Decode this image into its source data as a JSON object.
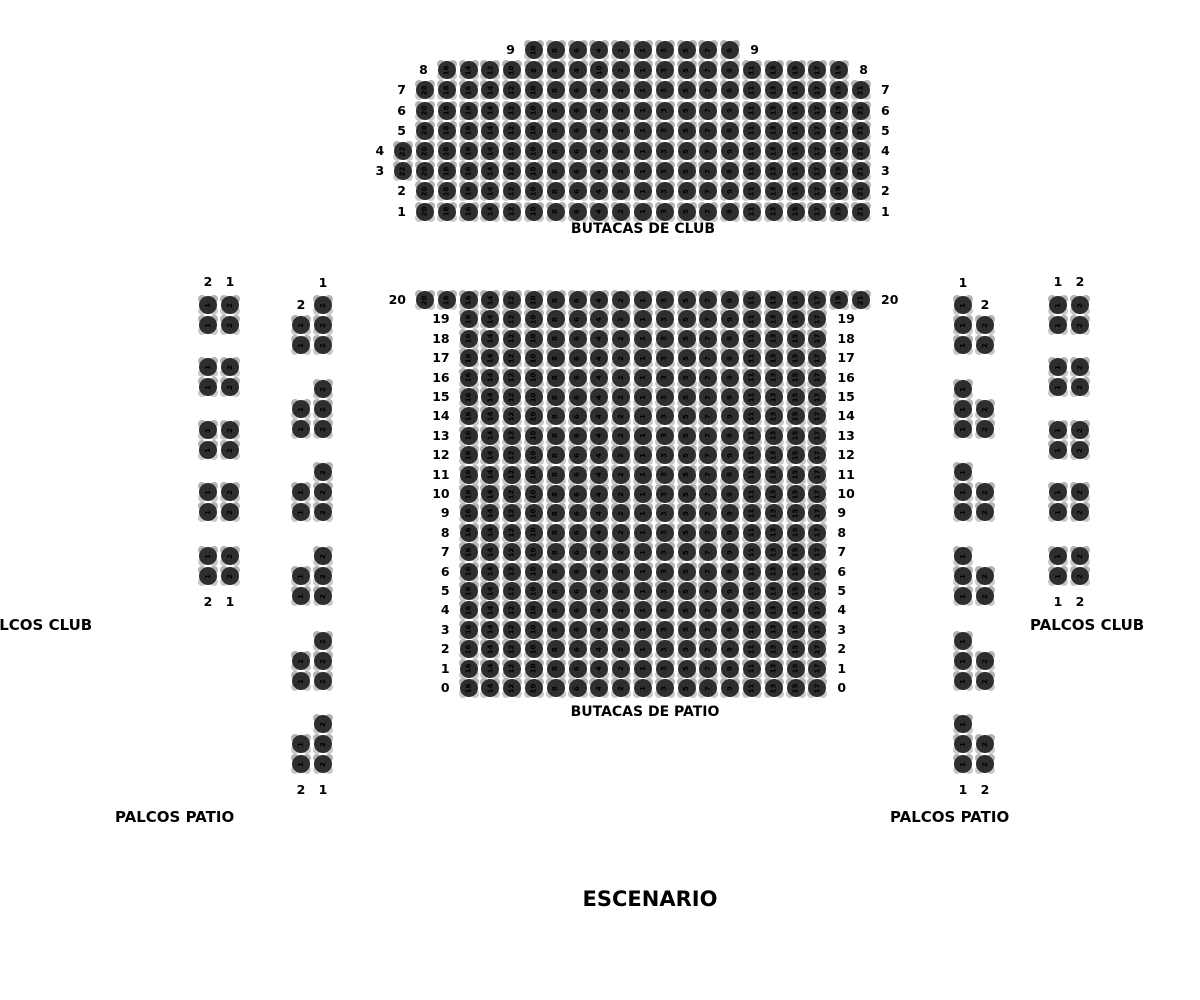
{
  "section_labels": {
    "club": "BUTACAS DE CLUB",
    "patio": "BUTACAS DE PATIO",
    "palcos_club_left": "PALCOS CLUB",
    "palcos_club_right": "PALCOS CLUB",
    "palcos_patio_left": "PALCOS PATIO",
    "palcos_patio_right": "PALCOS PATIO",
    "stage": "ESCENARIO"
  },
  "colors": {
    "seat_fill": "#2e2e2e",
    "seat_number": "#000000",
    "label_text": "#000000",
    "background": "#ffffff"
  },
  "club": {
    "rows": [
      {
        "label": "9",
        "start_col": -5,
        "seats": [
          10,
          8,
          6,
          4,
          2,
          1,
          3,
          5,
          7,
          9
        ]
      },
      {
        "label": "8",
        "start_col": -9,
        "seats": [
          16,
          14,
          12,
          10,
          8,
          6,
          4,
          10,
          2,
          1,
          3,
          5,
          7,
          9,
          11,
          13,
          15,
          17,
          19
        ]
      },
      {
        "label": "7",
        "start_col": -10,
        "seats": [
          20,
          18,
          16,
          14,
          12,
          10,
          8,
          6,
          4,
          2,
          1,
          3,
          5,
          7,
          9,
          11,
          13,
          15,
          17,
          19,
          21
        ]
      },
      {
        "label": "6",
        "start_col": -10,
        "seats": [
          20,
          18,
          16,
          14,
          12,
          10,
          8,
          6,
          4,
          2,
          1,
          3,
          5,
          7,
          9,
          11,
          13,
          15,
          17,
          19,
          21
        ]
      },
      {
        "label": "5",
        "start_col": -10,
        "seats": [
          20,
          18,
          16,
          14,
          12,
          10,
          8,
          6,
          4,
          2,
          1,
          3,
          5,
          7,
          9,
          11,
          13,
          15,
          17,
          19,
          21
        ]
      },
      {
        "label": "4",
        "start_col": -11,
        "seats": [
          22,
          20,
          18,
          16,
          14,
          12,
          10,
          8,
          6,
          4,
          2,
          1,
          3,
          5,
          7,
          9,
          11,
          13,
          15,
          17,
          19,
          21
        ]
      },
      {
        "label": "3",
        "start_col": -11,
        "seats": [
          22,
          20,
          18,
          16,
          14,
          12,
          10,
          8,
          6,
          4,
          2,
          1,
          3,
          5,
          7,
          9,
          11,
          13,
          15,
          17,
          19,
          21
        ]
      },
      {
        "label": "2",
        "start_col": -10,
        "seats": [
          20,
          18,
          16,
          14,
          12,
          10,
          8,
          6,
          4,
          2,
          1,
          3,
          5,
          7,
          9,
          11,
          13,
          15,
          17,
          19,
          21
        ]
      },
      {
        "label": "1",
        "start_col": -10,
        "seats": [
          20,
          18,
          16,
          14,
          12,
          10,
          8,
          6,
          4,
          2,
          1,
          3,
          5,
          7,
          9,
          11,
          13,
          15,
          17,
          19,
          21
        ]
      }
    ]
  },
  "patio": {
    "rows": [
      {
        "label": "20",
        "start_col": -10,
        "seats": [
          20,
          18,
          16,
          14,
          12,
          10,
          8,
          6,
          4,
          2,
          1,
          3,
          5,
          7,
          9,
          11,
          13,
          15,
          17,
          19,
          21
        ]
      },
      {
        "label": "19",
        "start_col": -8,
        "seats": [
          16,
          14,
          12,
          10,
          8,
          6,
          4,
          2,
          1,
          3,
          5,
          7,
          9,
          11,
          13,
          15,
          17
        ]
      },
      {
        "label": "18",
        "start_col": -8,
        "seats": [
          16,
          14,
          12,
          10,
          8,
          6,
          4,
          2,
          1,
          3,
          5,
          7,
          9,
          11,
          13,
          15,
          17
        ]
      },
      {
        "label": "17",
        "start_col": -8,
        "seats": [
          16,
          14,
          12,
          10,
          8,
          6,
          4,
          2,
          1,
          3,
          5,
          7,
          9,
          11,
          13,
          15,
          17
        ]
      },
      {
        "label": "16",
        "start_col": -8,
        "seats": [
          16,
          14,
          12,
          10,
          8,
          6,
          4,
          2,
          1,
          3,
          5,
          7,
          9,
          11,
          13,
          15,
          17
        ]
      },
      {
        "label": "15",
        "start_col": -8,
        "seats": [
          16,
          14,
          12,
          10,
          8,
          6,
          4,
          2,
          1,
          3,
          5,
          7,
          9,
          11,
          13,
          15,
          17
        ]
      },
      {
        "label": "14",
        "start_col": -8,
        "seats": [
          16,
          14,
          12,
          10,
          8,
          6,
          4,
          2,
          1,
          3,
          5,
          7,
          9,
          11,
          13,
          15,
          17
        ]
      },
      {
        "label": "13",
        "start_col": -8,
        "seats": [
          16,
          14,
          12,
          10,
          8,
          6,
          4,
          2,
          1,
          3,
          5,
          7,
          9,
          11,
          13,
          15,
          17
        ]
      },
      {
        "label": "12",
        "start_col": -8,
        "seats": [
          16,
          14,
          12,
          10,
          8,
          6,
          4,
          2,
          1,
          3,
          5,
          7,
          9,
          11,
          13,
          15,
          17
        ]
      },
      {
        "label": "11",
        "start_col": -8,
        "seats": [
          16,
          14,
          12,
          10,
          8,
          6,
          4,
          2,
          1,
          3,
          5,
          7,
          9,
          11,
          13,
          15,
          17
        ]
      },
      {
        "label": "10",
        "start_col": -8,
        "seats": [
          16,
          14,
          12,
          10,
          8,
          6,
          4,
          2,
          1,
          3,
          5,
          7,
          9,
          11,
          13,
          15,
          17
        ]
      },
      {
        "label": "9",
        "start_col": -8,
        "seats": [
          16,
          14,
          12,
          10,
          8,
          6,
          4,
          2,
          1,
          3,
          5,
          7,
          9,
          11,
          13,
          15,
          17
        ]
      },
      {
        "label": "8",
        "start_col": -8,
        "seats": [
          16,
          14,
          12,
          10,
          8,
          6,
          4,
          2,
          1,
          3,
          5,
          7,
          9,
          11,
          13,
          15,
          17
        ]
      },
      {
        "label": "7",
        "start_col": -8,
        "seats": [
          16,
          14,
          12,
          10,
          8,
          6,
          4,
          2,
          1,
          3,
          5,
          7,
          9,
          11,
          13,
          15,
          17
        ]
      },
      {
        "label": "6",
        "start_col": -8,
        "seats": [
          16,
          14,
          12,
          10,
          8,
          6,
          4,
          2,
          1,
          3,
          5,
          7,
          9,
          11,
          13,
          15,
          17
        ]
      },
      {
        "label": "5",
        "start_col": -8,
        "seats": [
          16,
          14,
          12,
          10,
          8,
          6,
          4,
          2,
          1,
          3,
          5,
          7,
          9,
          11,
          13,
          15,
          17
        ]
      },
      {
        "label": "4",
        "start_col": -8,
        "seats": [
          16,
          14,
          12,
          10,
          8,
          6,
          4,
          2,
          1,
          3,
          5,
          7,
          9,
          11,
          13,
          15,
          17
        ]
      },
      {
        "label": "3",
        "start_col": -8,
        "seats": [
          16,
          14,
          12,
          10,
          8,
          6,
          4,
          2,
          1,
          3,
          5,
          7,
          9,
          11,
          13,
          15,
          17
        ]
      },
      {
        "label": "2",
        "start_col": -8,
        "seats": [
          16,
          14,
          12,
          10,
          8,
          6,
          4,
          2,
          1,
          3,
          5,
          7,
          9,
          11,
          13,
          15,
          17
        ]
      },
      {
        "label": "1",
        "start_col": -8,
        "seats": [
          16,
          14,
          12,
          10,
          8,
          6,
          4,
          2,
          1,
          3,
          5,
          7,
          9,
          11,
          13,
          15,
          17
        ]
      },
      {
        "label": "0",
        "start_col": -8,
        "seats": [
          16,
          14,
          12,
          10,
          8,
          6,
          4,
          2,
          1,
          3,
          5,
          7,
          9,
          11,
          13,
          15,
          17
        ]
      }
    ]
  },
  "palcos": {
    "left_outer": {
      "top_labels": [
        "2",
        "1"
      ],
      "bottom_labels": [
        "2",
        "1"
      ],
      "groups": [
        [
          [
            1,
            2
          ],
          [
            1,
            2
          ]
        ],
        [
          [
            1,
            2
          ],
          [
            1,
            2
          ]
        ],
        [
          [
            1,
            2
          ],
          [
            1,
            2
          ]
        ],
        [
          [
            1,
            2
          ],
          [
            1,
            2
          ]
        ],
        [
          [
            1,
            2
          ],
          [
            1,
            2
          ]
        ]
      ]
    },
    "left_inner": {
      "header_label": "1",
      "first_row_label": "2",
      "bottom_labels": [
        "2",
        "1"
      ],
      "groups": [
        [
          [
            null,
            2
          ],
          [
            1,
            2
          ],
          [
            1,
            2
          ]
        ],
        [
          [
            null,
            2
          ],
          [
            1,
            2
          ],
          [
            1,
            2
          ]
        ],
        [
          [
            null,
            2
          ],
          [
            1,
            2
          ],
          [
            1,
            2
          ]
        ],
        [
          [
            null,
            2
          ],
          [
            1,
            2
          ],
          [
            1,
            2
          ]
        ],
        [
          [
            null,
            2
          ],
          [
            1,
            2
          ],
          [
            1,
            2
          ]
        ],
        [
          [
            null,
            2
          ],
          [
            1,
            2
          ],
          [
            1,
            2
          ]
        ]
      ]
    },
    "right_inner": {
      "header_label": "1",
      "first_row_label": "2",
      "bottom_labels": [
        "1",
        "2"
      ],
      "groups": [
        [
          [
            1,
            null
          ],
          [
            1,
            2
          ],
          [
            1,
            2
          ]
        ],
        [
          [
            1,
            null
          ],
          [
            1,
            2
          ],
          [
            1,
            2
          ]
        ],
        [
          [
            1,
            null
          ],
          [
            1,
            2
          ],
          [
            1,
            2
          ]
        ],
        [
          [
            1,
            null
          ],
          [
            1,
            2
          ],
          [
            1,
            2
          ]
        ],
        [
          [
            1,
            null
          ],
          [
            1,
            2
          ],
          [
            1,
            2
          ]
        ],
        [
          [
            1,
            null
          ],
          [
            1,
            2
          ],
          [
            1,
            2
          ]
        ]
      ]
    },
    "right_outer": {
      "top_labels": [
        "1",
        "2"
      ],
      "bottom_labels": [
        "1",
        "2"
      ],
      "groups": [
        [
          [
            1,
            2
          ],
          [
            1,
            2
          ]
        ],
        [
          [
            1,
            2
          ],
          [
            1,
            2
          ]
        ],
        [
          [
            1,
            2
          ],
          [
            1,
            2
          ]
        ],
        [
          [
            1,
            2
          ],
          [
            1,
            2
          ]
        ],
        [
          [
            1,
            2
          ],
          [
            1,
            2
          ]
        ]
      ]
    }
  }
}
